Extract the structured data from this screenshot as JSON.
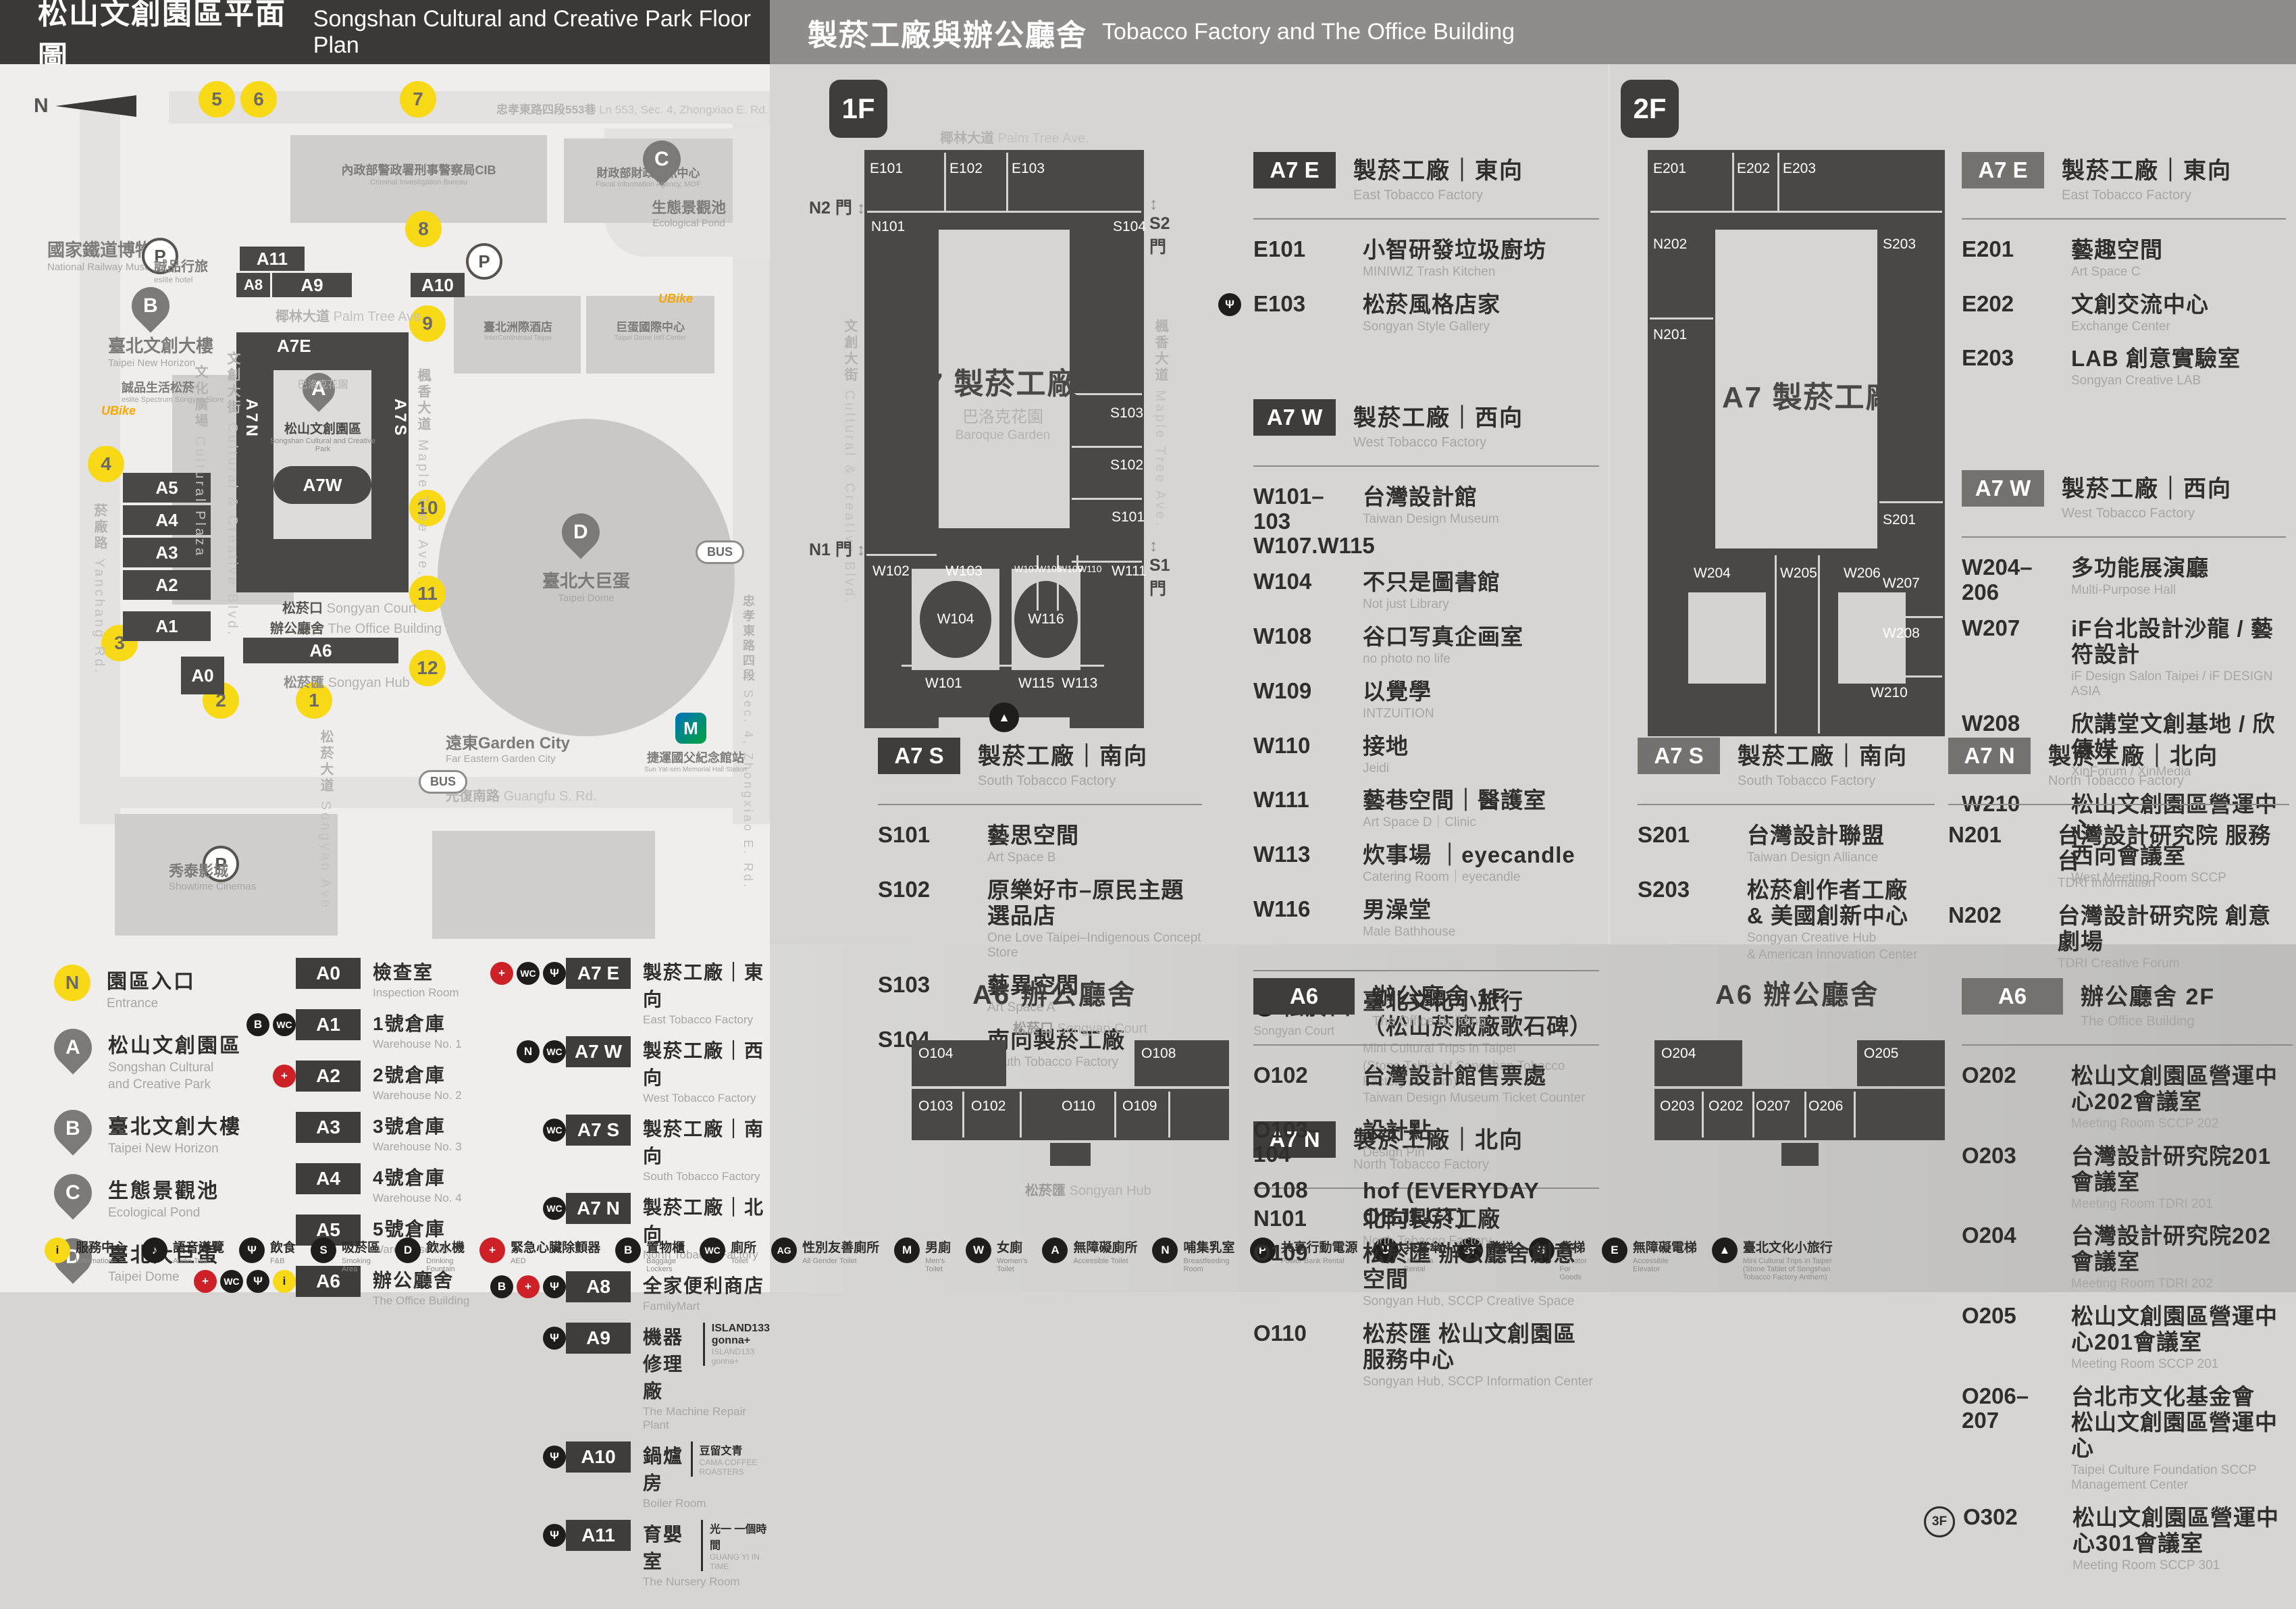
{
  "colors": {
    "accent_yellow": "#f7d917",
    "aed_red": "#cd2027",
    "building_dark": "#4a4846",
    "badge_dark": "#3f3d3b",
    "badge_gray": "#73726f"
  },
  "headerLeft": {
    "zh": "松山文創園區平面圖",
    "en": "Songshan Cultural and Creative Park Floor Plan"
  },
  "headerRight": {
    "zh": "製菸工廠與辦公廳舍",
    "en": "Tobacco Factory and The Office Building"
  },
  "map": {
    "north": "N",
    "entrances": [
      "1",
      "2",
      "3",
      "4",
      "5",
      "6",
      "7",
      "8",
      "9",
      "10",
      "11",
      "12"
    ],
    "pins": {
      "a": "A",
      "b": "B",
      "c": "C",
      "d": "D"
    },
    "bld": {
      "a0": "A0",
      "a1": "A1",
      "a2": "A2",
      "a3": "A3",
      "a4": "A4",
      "a5": "A5",
      "a6": "A6",
      "a8": "A8",
      "a9": "A9",
      "a10": "A10",
      "a11": "A11",
      "a7e": "A7E",
      "a7w": "A7W",
      "a7n": "A7N",
      "a7s": "A7S"
    },
    "labels": {
      "railway_museum": {
        "zh": "國家鐵道博物館",
        "en": "National Railway Museum"
      },
      "eslite_hotel": {
        "zh": "誠品行旅",
        "en": "eslite hotel"
      },
      "new_horizon": {
        "zh": "臺北文創大樓",
        "en": "Taipei New Horizon"
      },
      "eslite_spectrum": {
        "zh": "誠品生活松菸",
        "en": "eslite Spectrum Songyan Store"
      },
      "cultural_plaza": {
        "zh": "文化廣場",
        "en": "Cultural Plaza"
      },
      "cc_blvd": {
        "zh": "文創大街",
        "en": "Cultural & Creative Blvd."
      },
      "palm_ave": {
        "zh": "椰林大道",
        "en": "Palm Tree Ave."
      },
      "yanchang_rd": {
        "zh": "菸廠路",
        "en": "Yanchang Rd."
      },
      "maple_ave": {
        "zh": "楓香大道",
        "en": "Maple Tree Ave."
      },
      "songyan_ave": {
        "zh": "松菸大道",
        "en": "Songyan Ave."
      },
      "baroque": {
        "zh": "巴洛克花園",
        "en": "Baroque Garden"
      },
      "songyan_court": {
        "zh": "松菸口",
        "en": "Songyan Court"
      },
      "office_bldg": {
        "zh": "辦公廳舍",
        "en": "The Office Building"
      },
      "songyan_hub": {
        "zh": "松菸匯",
        "en": "Songyan Hub"
      },
      "eco_pond": {
        "zh": "生態景觀池",
        "en": "Ecological Pond"
      },
      "scc_park": {
        "zh": "松山文創園區",
        "en": "Songshan Cultural and Creative Park"
      },
      "taipei_dome": {
        "zh": "臺北大巨蛋",
        "en": "Taipei Dome"
      },
      "cib": {
        "zh": "內政部警政署刑事警察局CIB",
        "en": "Criminal Investigation Bureau"
      },
      "fia": {
        "zh": "財政部財政資訊中心",
        "en": "Fiscal Information Agency, MOF"
      },
      "intercontinental": {
        "zh": "臺北洲際酒店",
        "en": "InterContinental Taipei"
      },
      "dome_center": {
        "zh": "巨蛋國際中心",
        "en": "Taipei Dome Int'l Center"
      },
      "garden_city": {
        "zh": "遠東Garden City",
        "en": "Far Eastern Garden City"
      },
      "showtime": {
        "zh": "秀泰影城",
        "en": "Showtime Cinemas"
      },
      "mrt": {
        "zh": "捷運國父紀念館站",
        "en": "Sun Yat-sen Memorial Hall Station"
      },
      "zhongxiao_lane": {
        "zh": "忠孝東路四段553巷",
        "en": "Ln 553, Sec. 4, Zhongxiao E. Rd."
      },
      "zhongxiao_rd": {
        "zh": "忠孝東路四段",
        "en": "Sec. 4, Zhongxiao E. Rd."
      },
      "guangfu_rd": {
        "zh": "光復南路",
        "en": "Guangfu S. Rd."
      },
      "ubike": "UBike",
      "bus": "BUS",
      "parking": "P",
      "metro": "M"
    }
  },
  "legend": {
    "markers": [
      {
        "kind": "entrance",
        "letter": "N",
        "zh": "園區入口",
        "en": "Entrance"
      },
      {
        "kind": "pin",
        "letter": "A",
        "zh": "松山文創園區",
        "en": "Songshan Cultural",
        "en2": "and Creative Park"
      },
      {
        "kind": "pin",
        "letter": "B",
        "zh": "臺北文創大樓",
        "en": "Taipei New Horizon"
      },
      {
        "kind": "pin",
        "letter": "C",
        "zh": "生態景觀池",
        "en": "Ecological Pond"
      },
      {
        "kind": "pin",
        "letter": "D",
        "zh": "臺北大巨蛋",
        "en": "Taipei Dome"
      }
    ],
    "colA": [
      {
        "code": "A0",
        "zh": "檢查室",
        "en": "Inspection Room"
      },
      {
        "code": "A1",
        "zh": "1號倉庫",
        "en": "Warehouse No. 1",
        "icons": [
          "locker",
          "toilet"
        ]
      },
      {
        "code": "A2",
        "zh": "2號倉庫",
        "en": "Warehouse No. 2",
        "icons": [
          "aed"
        ]
      },
      {
        "code": "A3",
        "zh": "3號倉庫",
        "en": "Warehouse No. 3"
      },
      {
        "code": "A4",
        "zh": "4號倉庫",
        "en": "Warehouse No. 4"
      },
      {
        "code": "A5",
        "zh": "5號倉庫",
        "en": "Warehouse No. 5"
      },
      {
        "code": "A6",
        "zh": "辦公廳舍",
        "en": "The Office Building",
        "icons": [
          "aed",
          "toilet",
          "fnb",
          "info"
        ]
      }
    ],
    "colB": [
      {
        "code": "A7 E",
        "zh": "製菸工廠｜東向",
        "en": "East Tobacco Factory",
        "icons": [
          "aed",
          "toilet",
          "fnb"
        ]
      },
      {
        "code": "A7 W",
        "zh": "製菸工廠｜西向",
        "en": "West Tobacco Factory",
        "icons": [
          "nursing",
          "toilet"
        ]
      },
      {
        "code": "A7 S",
        "zh": "製菸工廠｜南向",
        "en": "South Tobacco Factory",
        "icons": [
          "toilet"
        ]
      },
      {
        "code": "A7 N",
        "zh": "製菸工廠｜北向",
        "en": "North Tobacco Factory",
        "icons": [
          "toilet"
        ]
      },
      {
        "code": "A8",
        "zh": "全家便利商店",
        "en": "FamilyMart",
        "icons": [
          "locker",
          "aed",
          "fnb"
        ]
      },
      {
        "code": "A9",
        "zh": "機器修理廠",
        "en": "The Machine Repair Plant",
        "side_zh": "ISLAND133 gonna+",
        "side_en": "ISLAND133 gonna+",
        "icons": [
          "fnb"
        ]
      },
      {
        "code": "A10",
        "zh": "鍋爐房",
        "en": "Boiler Room",
        "side_zh": "豆留文青",
        "side_en": "CAMA COFFEE ROASTERS",
        "icons": [
          "fnb"
        ]
      },
      {
        "code": "A11",
        "zh": "育嬰室",
        "en": "The Nursery Room",
        "side_zh": "光一 一個時間",
        "side_en": "GUANG YI IN TIME",
        "icons": [
          "fnb"
        ]
      }
    ]
  },
  "facilities": [
    {
      "icon": "info",
      "zh": "服務中心",
      "en": "Information"
    },
    {
      "icon": "audio",
      "zh": "語音導覽",
      "en": "Audio Tour"
    },
    {
      "icon": "fnb",
      "zh": "飲食",
      "en": "F&B"
    },
    {
      "icon": "smoke",
      "zh": "吸菸區",
      "en": "Smoking Area"
    },
    {
      "icon": "water",
      "zh": "飲水機",
      "en": "Drinking Fountain"
    },
    {
      "icon": "aed",
      "zh": "緊急心臟除顫器",
      "en": "AED"
    },
    {
      "icon": "locker",
      "zh": "置物櫃",
      "en": "Baggage Lockers"
    },
    {
      "icon": "toilet",
      "zh": "廁所",
      "en": "Toilet"
    },
    {
      "icon": "allgender",
      "zh": "性別友善廁所",
      "en": "All Gender Toilet"
    },
    {
      "icon": "men",
      "zh": "男廁",
      "en": "Men's Toilet"
    },
    {
      "icon": "women",
      "zh": "女廁",
      "en": "Women's Toilet"
    },
    {
      "icon": "access",
      "zh": "無障礙廁所",
      "en": "Accessible Toilet"
    },
    {
      "icon": "nursing",
      "zh": "哺集乳室",
      "en": "Breastfeeding Room"
    },
    {
      "icon": "power",
      "zh": "共享行動電源",
      "en": "Power Bank Rental"
    },
    {
      "icon": "umbrella",
      "zh": "共享傘",
      "en": "Umbrella Rental"
    },
    {
      "icon": "stairs",
      "zh": "階梯",
      "en": "Stairs"
    },
    {
      "icon": "cargo",
      "zh": "貨梯",
      "en": "Elevator For Goods"
    },
    {
      "icon": "elevator",
      "zh": "無障礙電梯",
      "en": "Accessible Elevator"
    },
    {
      "icon": "statue",
      "zh": "臺北文化小旅行",
      "en": "Mini Cultural Trips in Taipei (Stone Tablet of Songshan Tobacco Factory Anthem)"
    }
  ],
  "f1": {
    "badge": "1F",
    "plan": {
      "center": "A7 製菸工廠",
      "rooms": {
        "e101": "E101",
        "e102": "E102",
        "e103": "E103",
        "n101": "N101",
        "s101": "S101",
        "s102": "S102",
        "s103": "S103",
        "s104": "S104",
        "w101": "W101",
        "w102": "W102",
        "w103": "W103",
        "w104": "W104",
        "w107": "W107",
        "w108": "W108",
        "w109": "W109",
        "w110": "W110",
        "w111": "W111",
        "w113": "W113",
        "w115": "W115",
        "w116": "W116"
      },
      "gates": {
        "n1": "N1 門",
        "n2": "N2 門",
        "s1": "S1 門",
        "s2": "S2 門"
      }
    },
    "a7e": {
      "code": "A7 E",
      "zh": "製菸工廠｜東向",
      "en": "East Tobacco Factory",
      "items": [
        {
          "code": "E101",
          "zh": "小智研發垃圾廚坊",
          "en": "MINIWIZ Trash Kitchen"
        },
        {
          "code": "E103",
          "zh": "松菸風格店家",
          "en": "Songyan Style Gallery",
          "icon": "fnb"
        }
      ]
    },
    "a7w": {
      "code": "A7 W",
      "zh": "製菸工廠｜西向",
      "en": "West Tobacco Factory",
      "items": [
        {
          "code": "W101–103",
          "code2": "W107.W115",
          "zh": "台灣設計館",
          "en": "Taiwan Design Museum"
        },
        {
          "code": "W104",
          "zh": "不只是圖書館",
          "en": "Not just Library"
        },
        {
          "code": "W108",
          "zh": "谷口写真企画室",
          "en": "no photo no life"
        },
        {
          "code": "W109",
          "zh": "以覺學",
          "en": "INTZUiTION"
        },
        {
          "code": "W110",
          "zh": "接地",
          "en": "Jeidi"
        },
        {
          "code": "W111",
          "zh": "藝巷空間｜醫護室",
          "en": "Art Space D｜Clinic"
        },
        {
          "code": "W113",
          "zh": "炊事場 ｜eyecandle",
          "en": "Catering Room｜eyecandle"
        },
        {
          "code": "W116",
          "zh": "男澡堂",
          "en": "Male Bathhouse"
        }
      ]
    },
    "a7s": {
      "code": "A7 S",
      "zh": "製菸工廠｜南向",
      "en": "South Tobacco Factory",
      "items": [
        {
          "code": "S101",
          "zh": "藝思空間",
          "en": "Art Space B"
        },
        {
          "code": "S102",
          "zh": "原樂好市–原民主題選品店",
          "en": "One Love Taipei–Indigenous Concept Store"
        },
        {
          "code": "S103",
          "zh": "藝異空間",
          "en": "Art Space A"
        },
        {
          "code": "S104",
          "zh": "南向製菸工廠",
          "en": "South Tobacco Factory"
        }
      ]
    },
    "court": {
      "zh": "松菸口",
      "en": "Songyan Court",
      "t_zh1": "臺北文化小旅行",
      "t_zh2": "（松山菸廠廠歌石碑）",
      "t_en1": "Mini Cultural Trips in Taipei",
      "t_en2": "(Stone Tablet of Songshan Tobacco Factory Anthem)"
    },
    "a7n": {
      "code": "A7 N",
      "zh": "製菸工廠｜北向",
      "en": "North Tobacco Factory",
      "items": [
        {
          "code": "N101",
          "zh": "北向製菸工廠",
          "en": "North Tobacco Factory"
        }
      ]
    }
  },
  "f2": {
    "badge": "2F",
    "plan": {
      "center": "A7 製菸工廠",
      "rooms": {
        "e201": "E201",
        "e202": "E202",
        "e203": "E203",
        "n201": "N201",
        "n202": "N202",
        "s201": "S201",
        "s203": "S203",
        "w204": "W204",
        "w205": "W205",
        "w206": "W206",
        "w207": "W207",
        "w208": "W208",
        "w210": "W210"
      }
    },
    "a7e": {
      "code": "A7 E",
      "zh": "製菸工廠｜東向",
      "en": "East Tobacco Factory",
      "items": [
        {
          "code": "E201",
          "zh": "藝趣空間",
          "en": "Art Space C"
        },
        {
          "code": "E202",
          "zh": "文創交流中心",
          "en": "Exchange Center"
        },
        {
          "code": "E203",
          "zh": "LAB 創意實驗室",
          "en": "Songyan Creative LAB"
        }
      ]
    },
    "a7w": {
      "code": "A7 W",
      "zh": "製菸工廠｜西向",
      "en": "West Tobacco Factory",
      "items": [
        {
          "code": "W204–206",
          "zh": "多功能展演廳",
          "en": "Multi-Purpose Hall"
        },
        {
          "code": "W207",
          "zh": "iF台北設計沙龍 / 藝符設計",
          "en": "iF Design Salon Taipei / iF DESIGN ASIA"
        },
        {
          "code": "W208",
          "zh": "欣講堂文創基地 / 欣傳媒",
          "en": "XinForum / XinMedia"
        },
        {
          "code": "W210",
          "zh": "松山文創園區營運中心",
          "zh2": "西向會議室",
          "en": "West Meeting Room SCCP"
        }
      ]
    },
    "a7s": {
      "code": "A7 S",
      "zh": "製菸工廠｜南向",
      "en": "South Tobacco Factory",
      "items": [
        {
          "code": "S201",
          "zh": "台灣設計聯盟",
          "en": "Taiwan Design Alliance"
        },
        {
          "code": "S203",
          "zh": "松菸創作者工廠",
          "zh2": "& 美國創新中心",
          "en": "Songyan Creative Hub",
          "en2": "& American Innovation Center"
        }
      ]
    },
    "a7n": {
      "code": "A7 N",
      "zh": "製菸工廠｜北向",
      "en": "North Tobacco Factory",
      "items": [
        {
          "code": "N201",
          "zh": "台灣設計研究院 服務台",
          "en": "TDRI Information"
        },
        {
          "code": "N202",
          "zh": "台灣設計研究院 創意劇場",
          "en": "TDRI Creative Forum"
        }
      ]
    }
  },
  "office": {
    "a6f1": {
      "plan_title": "A6 辦公廳舍",
      "badge": "A6",
      "zh": "辦公廳舍 1F",
      "en": "The Office Building",
      "rooms": {
        "o102": "O102",
        "o103": "O103",
        "o104": "O104",
        "o108": "O108",
        "o109": "O109",
        "o110": "O110"
      },
      "items": [
        {
          "code": "O102",
          "zh": "台灣設計館售票處",
          "en": "Taiwan Design Museum Ticket Counter"
        },
        {
          "code": "O103–104",
          "zh": "設計點",
          "en": "Design Pin"
        },
        {
          "code": "O108",
          "zh": "hof (EVERYDAY OBJECT)"
        },
        {
          "code": "O109",
          "zh": "松菸匯 辦公廳舍創意空間",
          "en": "Songyan Hub, SCCP Creative Space"
        },
        {
          "code": "O110",
          "zh": "松菸匯 松山文創園區服務中心",
          "en": "Songyan Hub, SCCP Information Center"
        }
      ]
    },
    "a6f2": {
      "plan_title": "A6 辦公廳舍",
      "badge": "A6",
      "zh": "辦公廳舍 2F",
      "en": "The Office Building",
      "rooms": {
        "o202": "O202",
        "o203": "O203",
        "o204": "O204",
        "o205": "O205",
        "o206": "O206",
        "o207": "O207"
      },
      "items": [
        {
          "code": "O202",
          "zh": "松山文創園區營運中心202會議室",
          "en": "Meeting Room SCCP 202"
        },
        {
          "code": "O203",
          "zh": "台灣設計研究院201會議室",
          "en": "Meeting Room TDRI 201"
        },
        {
          "code": "O204",
          "zh": "台灣設計研究院202會議室",
          "en": "Meeting Room TDRI 202"
        },
        {
          "code": "O205",
          "zh": "松山文創園區營運中心201會議室",
          "en": "Meeting Room SCCP 201"
        },
        {
          "code": "O206–207",
          "zh": "台北市文化基金會",
          "zh2": "松山文創園區營運中心",
          "en": "Taipei Culture Foundation SCCP Management Center"
        },
        {
          "code": "O302",
          "prefix": "3F",
          "zh": "松山文創園區營運中心301會議室",
          "en": "Meeting Room SCCP 301"
        }
      ]
    }
  }
}
